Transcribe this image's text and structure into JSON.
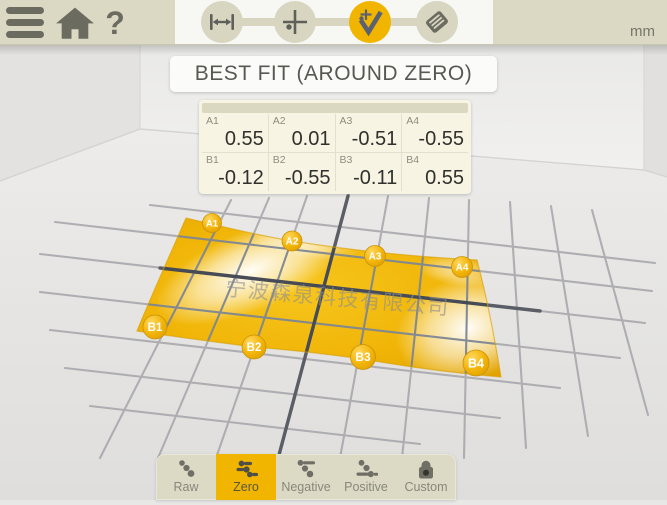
{
  "topbar": {
    "unit": "mm",
    "steps": [
      {
        "name": "length-setup",
        "icon": "length-arrows-icon",
        "selected": false
      },
      {
        "name": "measure-points",
        "icon": "crosshair-point-icon",
        "selected": false
      },
      {
        "name": "best-fit-evaluation",
        "icon": "check-point-icon",
        "selected": true
      },
      {
        "name": "report",
        "icon": "report-icon",
        "selected": false
      }
    ]
  },
  "title": "BEST FIT (AROUND ZERO)",
  "table": {
    "rows": [
      {
        "cells": [
          {
            "label": "A1",
            "value": "0.55"
          },
          {
            "label": "A2",
            "value": "0.01"
          },
          {
            "label": "A3",
            "value": "-0.51"
          },
          {
            "label": "A4",
            "value": "-0.55"
          }
        ]
      },
      {
        "cells": [
          {
            "label": "B1",
            "value": "-0.12"
          },
          {
            "label": "B2",
            "value": "-0.55"
          },
          {
            "label": "B3",
            "value": "-0.11"
          },
          {
            "label": "B4",
            "value": "0.55"
          }
        ]
      }
    ]
  },
  "surface": {
    "watermark": "宁波森泉科技有限公司",
    "points": [
      "A1",
      "A2",
      "A3",
      "A4",
      "B1",
      "B2",
      "B3",
      "B4"
    ]
  },
  "tabs": [
    {
      "label": "Raw",
      "selected": false
    },
    {
      "label": "Zero",
      "selected": true
    },
    {
      "label": "Negative",
      "selected": false
    },
    {
      "label": "Positive",
      "selected": false
    },
    {
      "label": "Custom",
      "selected": false
    }
  ],
  "colors": {
    "accent_orange": "#f1b500",
    "topbar_beige": "#dbd9c4",
    "surface_gold": "#eeae00",
    "icon_gray": "#6b6b60"
  }
}
